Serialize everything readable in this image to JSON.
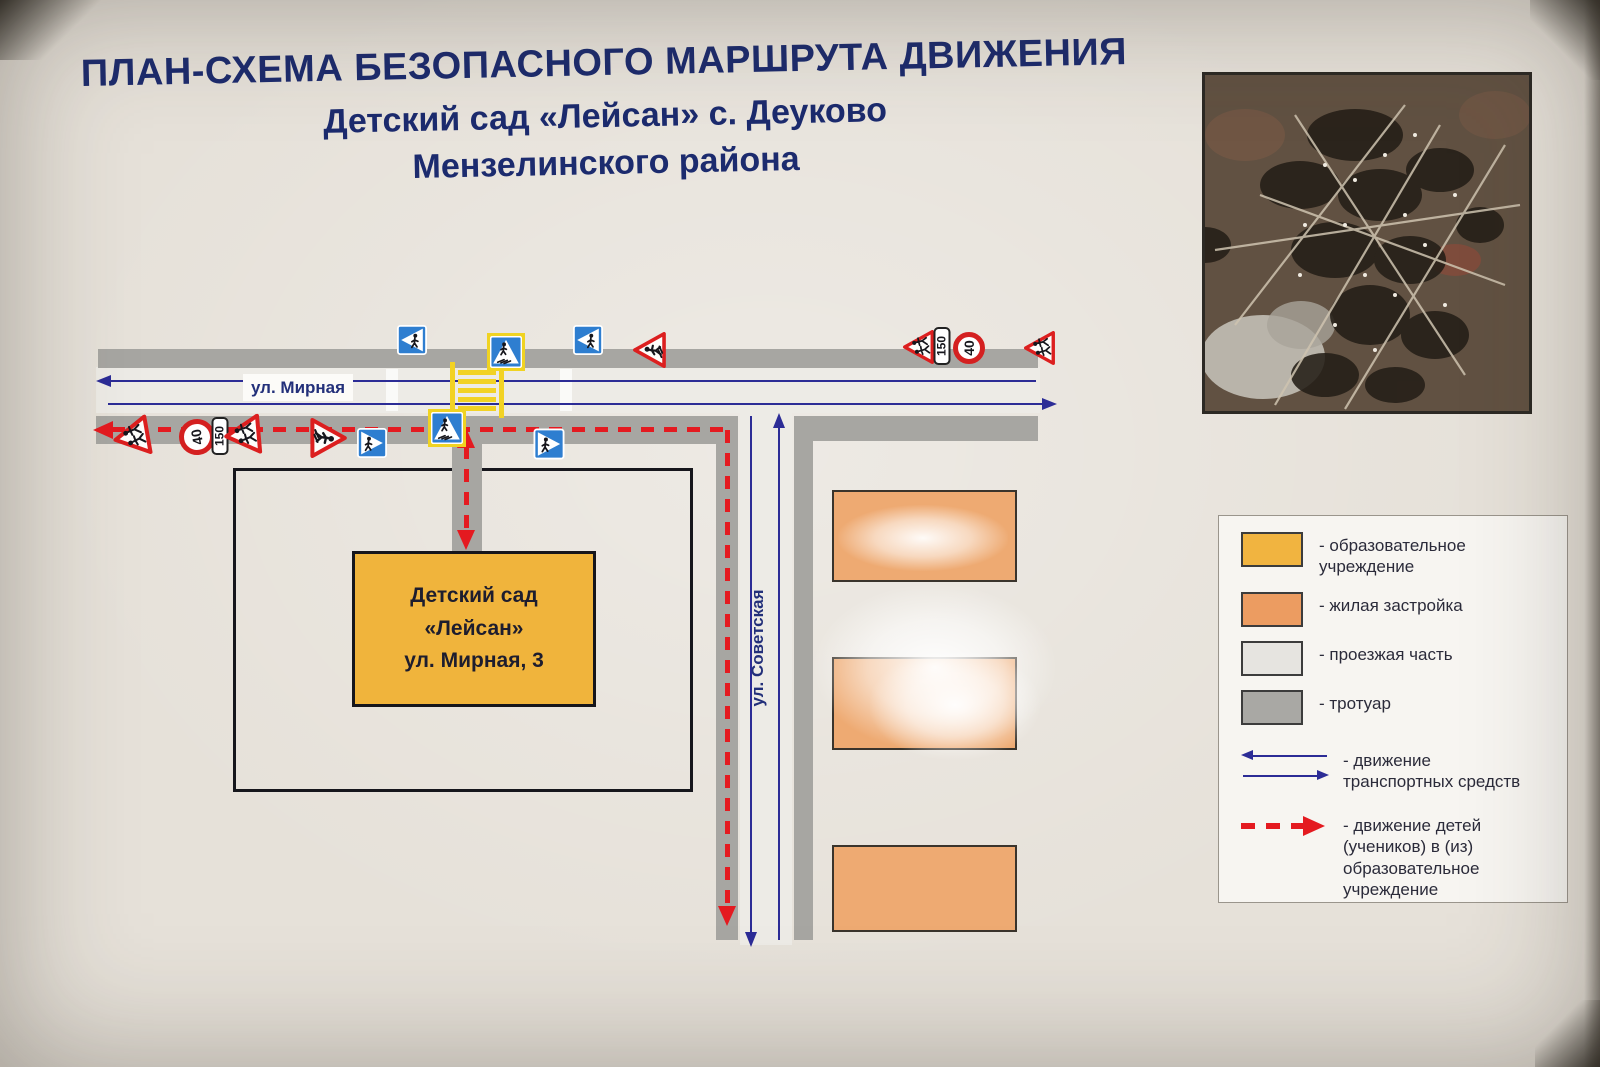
{
  "title": {
    "line1": "ПЛАН-СХЕМА БЕЗОПАСНОГО МАРШРУТА ДВИЖЕНИЯ",
    "line2": "Детский сад «Лейсан» с. Деуково",
    "line3": "Мензелинского района"
  },
  "map": {
    "street_mirnaya": "ул. Мирная",
    "street_sovetskaya": "ул. Советская",
    "kindergarten": {
      "line1": "Детский сад",
      "line2": "«Лейсан»",
      "line3": "ул. Мирная, 3"
    },
    "signs": {
      "speed_limit": "40",
      "distance_plate": "150"
    }
  },
  "legend": {
    "items": [
      {
        "key": "education",
        "color": "#f1b440",
        "label": "- образовательное\nучреждение"
      },
      {
        "key": "residential",
        "color": "#ec9c61",
        "label": "- жилая застройка"
      },
      {
        "key": "roadway",
        "color": "#e6e4e0",
        "label": "- проезжая часть"
      },
      {
        "key": "sidewalk",
        "color": "#a9a8a4",
        "label": "- тротуар"
      },
      {
        "key": "vehicle_traffic",
        "color": "#2c2c96",
        "label": "- движение\nтранспортных средств"
      },
      {
        "key": "children_route",
        "color": "#e41a20",
        "label": "- движение детей\n(учеников) в (из)\nобразовательное\nучреждение"
      }
    ]
  },
  "colors": {
    "title_text": "#1c2b6e",
    "background": "#e6e1d9",
    "roadway_fill": "#edebe6",
    "sidewalk_fill": "#a7a6a2",
    "traffic_line": "#2c2c96",
    "children_route": "#e41a20",
    "zebra_yellow": "#f2d224",
    "education_fill": "#f0b43c",
    "residential_fill": "#eeaa72"
  }
}
